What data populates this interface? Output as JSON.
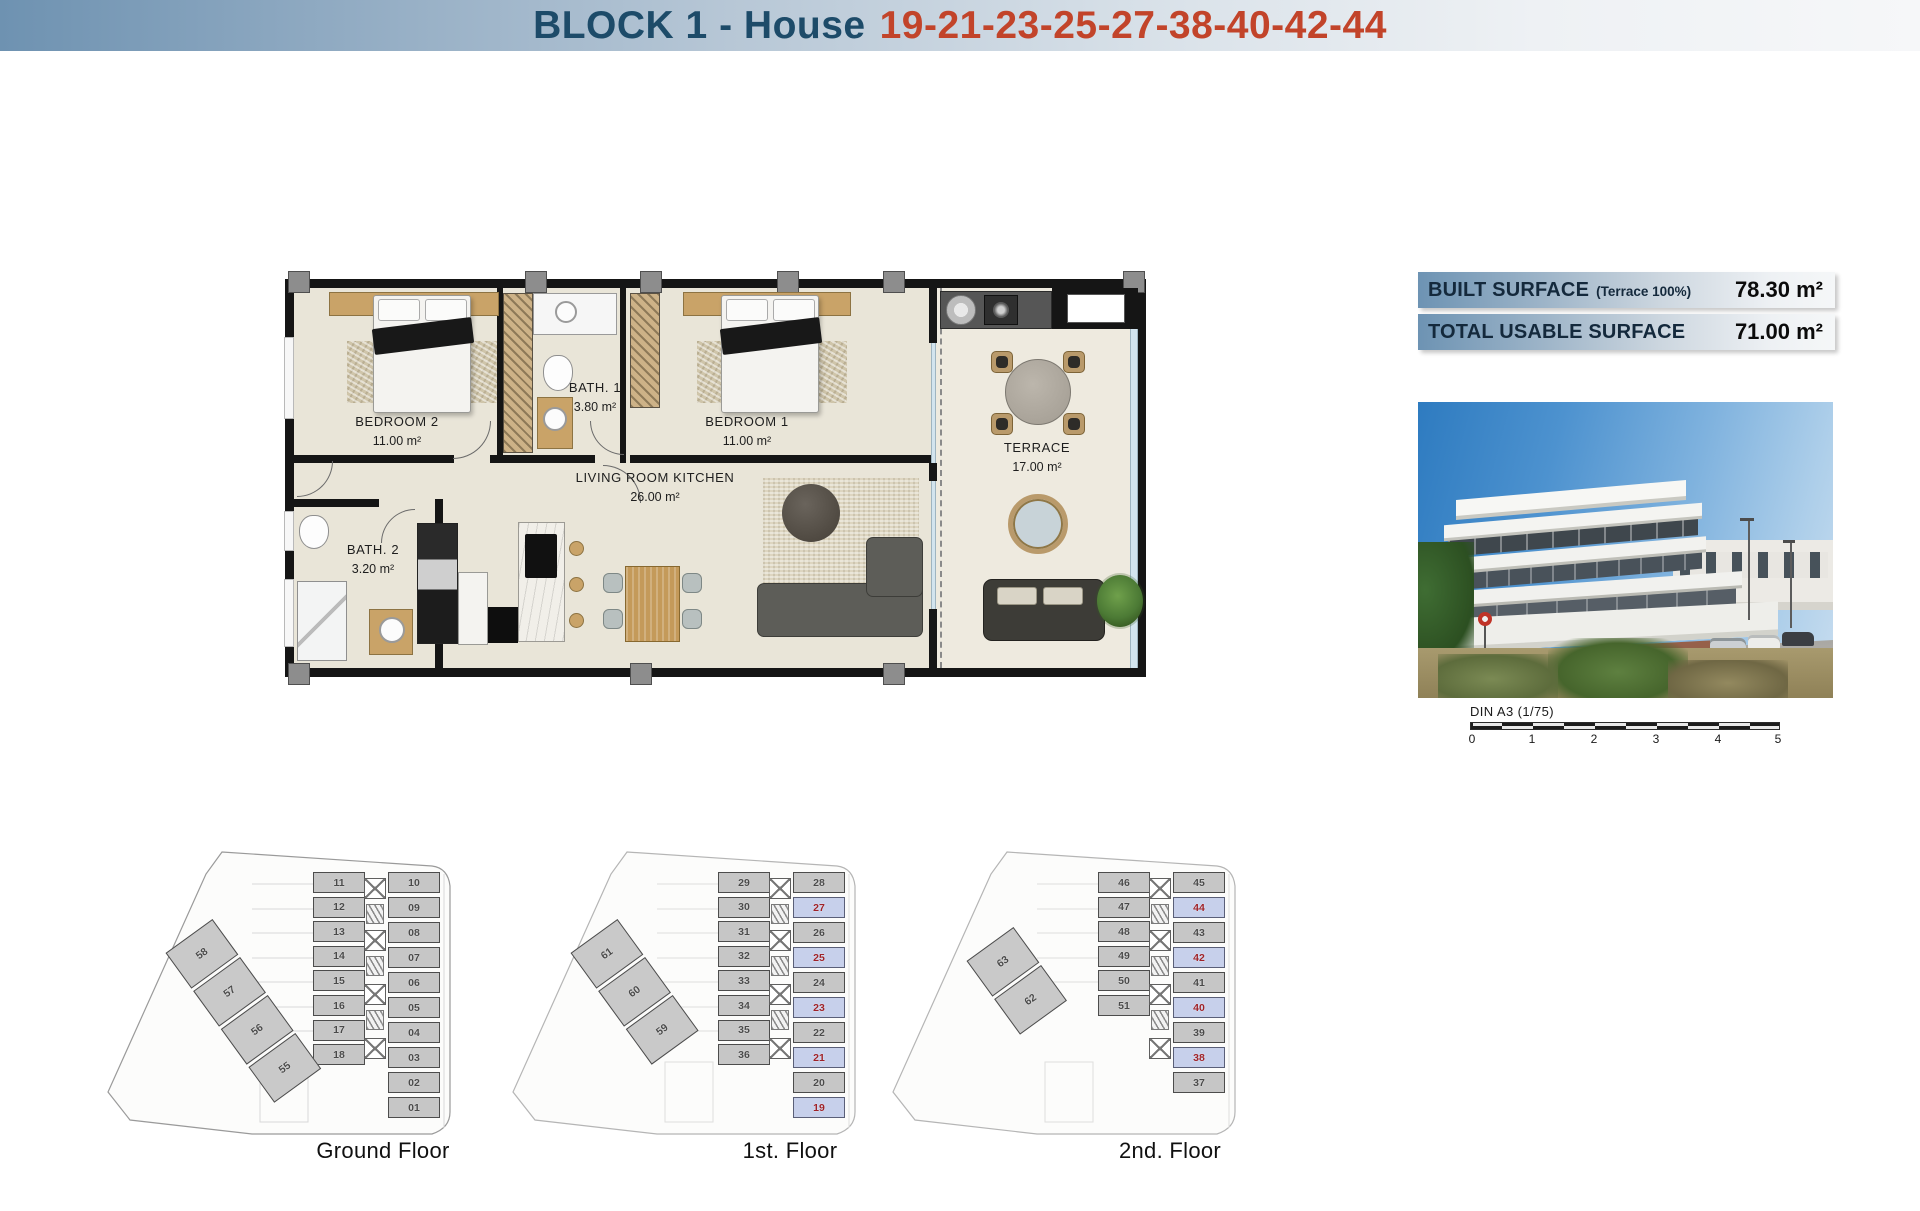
{
  "header": {
    "title_block": "BLOCK 1 - House",
    "title_numbers": "19-21-23-25-27-38-40-42-44"
  },
  "info_boxes": [
    {
      "label": "BUILT SURFACE",
      "note": "(Terrace 100%)",
      "value": "78.30 m²"
    },
    {
      "label": "TOTAL USABLE SURFACE",
      "note": "",
      "value": "71.00 m²"
    }
  ],
  "floorplan": {
    "rooms": [
      {
        "name": "BEDROOM 2",
        "area": "11.00 m²"
      },
      {
        "name": "BATH. 1",
        "area": "3.80 m²"
      },
      {
        "name": "BEDROOM 1",
        "area": "11.00 m²"
      },
      {
        "name": "LIVING ROOM KITCHEN",
        "area": "26.00 m²"
      },
      {
        "name": "BATH. 2",
        "area": "3.20 m²"
      },
      {
        "name": "TERRACE",
        "area": "17.00 m²"
      }
    ]
  },
  "scale_bar": {
    "label": "DIN A3 (1/75)",
    "ticks": [
      "0",
      "1",
      "2",
      "3",
      "4",
      "5"
    ]
  },
  "floors": [
    {
      "label": "Ground Floor",
      "left_units": [
        "11",
        "12",
        "13",
        "14",
        "15",
        "16",
        "17",
        "18"
      ],
      "right_units": [
        "10",
        "09",
        "08",
        "07",
        "06",
        "05",
        "04",
        "03",
        "02",
        "01"
      ],
      "diag_units": [
        "58",
        "57",
        "56",
        "55"
      ],
      "highlighted": []
    },
    {
      "label": "1st. Floor",
      "left_units": [
        "29",
        "30",
        "31",
        "32",
        "33",
        "34",
        "35",
        "36"
      ],
      "right_units": [
        "28",
        "27",
        "26",
        "25",
        "24",
        "23",
        "22",
        "21",
        "20",
        "19"
      ],
      "diag_units": [
        "61",
        "60",
        "59"
      ],
      "highlighted": [
        "27",
        "25",
        "23",
        "21",
        "19"
      ]
    },
    {
      "label": "2nd. Floor",
      "left_units": [
        "46",
        "47",
        "48",
        "49",
        "50",
        "51"
      ],
      "right_units": [
        "45",
        "44",
        "43",
        "42",
        "41",
        "40",
        "39",
        "38",
        "37"
      ],
      "diag_units": [
        "63",
        "62"
      ],
      "highlighted": [
        "44",
        "42",
        "40",
        "38"
      ]
    }
  ],
  "colors": {
    "title_blue": "#1d4b69",
    "title_orange": "#c2442a",
    "highlight_unit_bg": "#c7d0eb",
    "highlight_unit_text": "#9e2229"
  }
}
